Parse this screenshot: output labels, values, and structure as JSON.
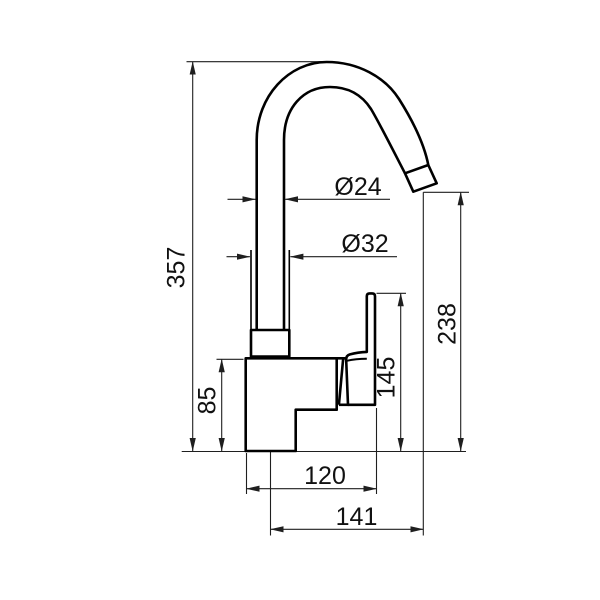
{
  "drawing": {
    "background_color": "#ffffff",
    "line_color": "#000000",
    "dimension_labels": {
      "total_height": "357",
      "spout_outlet_height": "238",
      "handle_top_height": "145",
      "body_height": "85",
      "body_width": "120",
      "spout_reach": "141",
      "spout_tube_diameter": "Ø24",
      "riser_diameter": "Ø32"
    }
  }
}
